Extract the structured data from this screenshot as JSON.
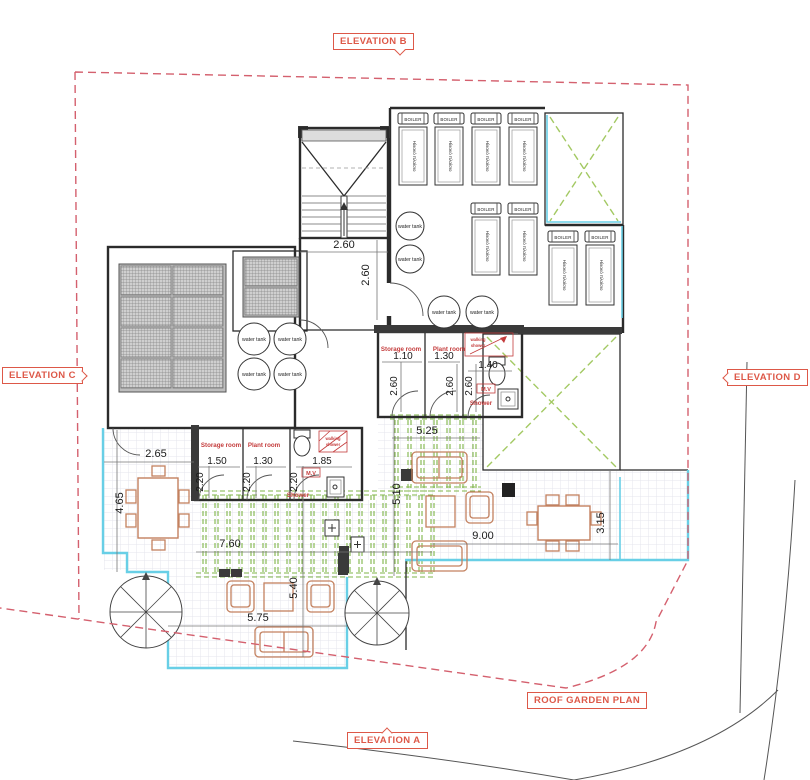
{
  "plan": {
    "title": "ROOF GARDEN PLAN",
    "elevations": {
      "a": "ELEVATION A",
      "b": "ELEVATION B",
      "c": "ELEVATION C",
      "d": "ELEVATION D"
    },
    "labels": {
      "boiler": "BOILER",
      "solar_panel": "Ηλιακό πλαίσιο",
      "water_tank": "water tank",
      "storage_room": "Storage room",
      "plant_room": "Plant room",
      "shower": "Shower",
      "walking_shower_l1": "walking",
      "walking_shower_l2": "shower",
      "mech_vent": "M.V"
    },
    "dims": {
      "stair_w": "2.60",
      "stair_h": "2.60",
      "f_storage_w": "1.10",
      "f_plant_w": "1.30",
      "f_bath_w": "1.40",
      "f_depth": "2.60",
      "pergola_w": "5.25",
      "pergola_h": "5.10",
      "terrace_e_w": "9.00",
      "terrace_e_h": "3.15",
      "pergola_s_w": "7.60",
      "terrace_s_h": "5.40",
      "terrace_s_w": "5.75",
      "terrace_w_w": "2.65",
      "terrace_w_h": "4.65",
      "g_storage_w": "1.50",
      "g_plant_w": "1.30",
      "g_bath_w": "1.85",
      "g_depth": "2.20"
    },
    "colors": {
      "boundary_red": "#d4606e",
      "marker_red": "#dd5848",
      "room_label_red": "#c43c3c",
      "pergola_green": "#7fb547",
      "void_x_green": "#a3c963",
      "railing_cyan": "#68cfe6",
      "furniture_brown": "#c3815f",
      "wall_dark": "#2b2b2b"
    }
  }
}
